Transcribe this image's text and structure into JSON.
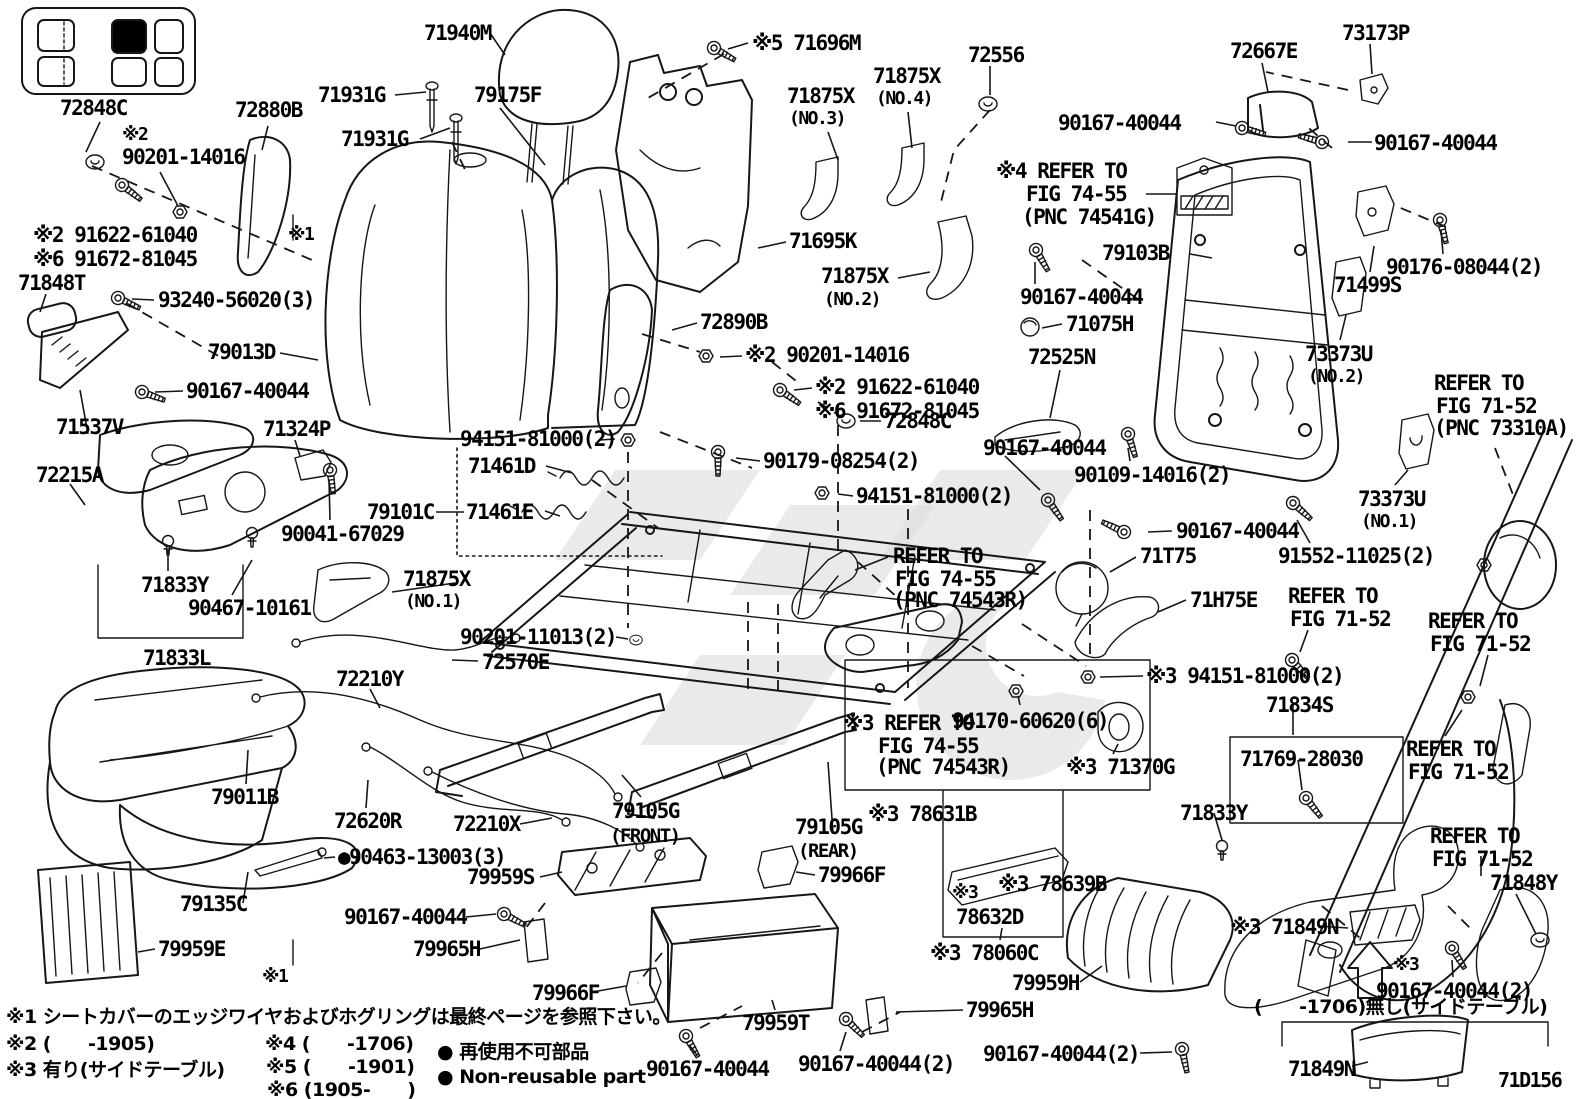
{
  "meta": {
    "figure_code": "71D156",
    "description_visible_language": "Japanese/English parts diagram"
  },
  "accent_colors": {
    "line": "#161616",
    "background": "#ffffff",
    "watermark": "#dcdcdc"
  },
  "labels": [
    {
      "text": "72848C",
      "x": 60,
      "y": 97
    },
    {
      "text": "※2",
      "x": 122,
      "y": 126,
      "fs": 18
    },
    {
      "text": "90201-14016",
      "x": 122,
      "y": 146
    },
    {
      "text": "72880B",
      "x": 235,
      "y": 99
    },
    {
      "text": "71931G",
      "x": 318,
      "y": 84
    },
    {
      "text": "71931G",
      "x": 341,
      "y": 128
    },
    {
      "text": "79175F",
      "x": 474,
      "y": 84
    },
    {
      "text": "71940M",
      "x": 424,
      "y": 22
    },
    {
      "text": "※5 71696M",
      "x": 752,
      "y": 32
    },
    {
      "text": "71875X",
      "x": 787,
      "y": 85
    },
    {
      "text": "(NO.3)",
      "x": 789,
      "y": 110,
      "fs": 18
    },
    {
      "text": "71875X",
      "x": 873,
      "y": 65
    },
    {
      "text": "(NO.4)",
      "x": 876,
      "y": 90,
      "fs": 18
    },
    {
      "text": "72556",
      "x": 968,
      "y": 44
    },
    {
      "text": "71695K",
      "x": 789,
      "y": 230
    },
    {
      "text": "71875X",
      "x": 821,
      "y": 265
    },
    {
      "text": "(NO.2)",
      "x": 824,
      "y": 291,
      "fs": 18
    },
    {
      "text": "90167-40044",
      "x": 1020,
      "y": 286
    },
    {
      "text": "71075H",
      "x": 1066,
      "y": 313
    },
    {
      "text": "72525N",
      "x": 1028,
      "y": 346
    },
    {
      "text": "90167-40044",
      "x": 1058,
      "y": 112
    },
    {
      "text": "72667E",
      "x": 1230,
      "y": 40
    },
    {
      "text": "73173P",
      "x": 1342,
      "y": 22
    },
    {
      "text": "90167-40044",
      "x": 1374,
      "y": 132
    },
    {
      "text": "※4 REFER TO",
      "x": 996,
      "y": 160
    },
    {
      "text": "FIG 74-55",
      "x": 1026,
      "y": 183
    },
    {
      "text": "(PNC 74541G)",
      "x": 1022,
      "y": 206
    },
    {
      "text": "79103B",
      "x": 1102,
      "y": 242
    },
    {
      "text": "90176-08044(2)",
      "x": 1386,
      "y": 256
    },
    {
      "text": "71499S",
      "x": 1334,
      "y": 274
    },
    {
      "text": "73373U",
      "x": 1305,
      "y": 343
    },
    {
      "text": "(NO.2)",
      "x": 1308,
      "y": 368,
      "fs": 18
    },
    {
      "text": "REFER TO",
      "x": 1434,
      "y": 372
    },
    {
      "text": "FIG 71-52",
      "x": 1436,
      "y": 395
    },
    {
      "text": "(PNC 73310A)",
      "x": 1434,
      "y": 417
    },
    {
      "text": "72890B",
      "x": 700,
      "y": 311
    },
    {
      "text": "※2 90201-14016",
      "x": 745,
      "y": 344
    },
    {
      "text": "※2 91622-61040",
      "x": 815,
      "y": 376
    },
    {
      "text": "※6 91672-81045",
      "x": 815,
      "y": 400
    },
    {
      "text": "72848C",
      "x": 884,
      "y": 410
    },
    {
      "text": "※2 91622-61040",
      "x": 33,
      "y": 224
    },
    {
      "text": "※6 91672-81045",
      "x": 33,
      "y": 248
    },
    {
      "text": "71848T",
      "x": 18,
      "y": 272
    },
    {
      "text": "93240-56020(3)",
      "x": 158,
      "y": 289
    },
    {
      "text": "79013D",
      "x": 208,
      "y": 341
    },
    {
      "text": "90167-40044",
      "x": 186,
      "y": 380
    },
    {
      "text": "71537V",
      "x": 56,
      "y": 416
    },
    {
      "text": "72215A",
      "x": 36,
      "y": 464
    },
    {
      "text": "71324P",
      "x": 263,
      "y": 418
    },
    {
      "text": "90041-67029",
      "x": 281,
      "y": 523
    },
    {
      "text": "71833Y",
      "x": 141,
      "y": 574
    },
    {
      "text": "90467-10161",
      "x": 188,
      "y": 597
    },
    {
      "text": "71833L",
      "x": 143,
      "y": 647
    },
    {
      "text": "※1",
      "x": 288,
      "y": 226,
      "fs": 18
    },
    {
      "text": "※1",
      "x": 262,
      "y": 968,
      "fs": 18
    },
    {
      "text": "94151-81000(2)",
      "x": 460,
      "y": 428
    },
    {
      "text": "71461D",
      "x": 468,
      "y": 455
    },
    {
      "text": "79101C",
      "x": 367,
      "y": 501
    },
    {
      "text": "71461E",
      "x": 466,
      "y": 501
    },
    {
      "text": "90179-08254(2)",
      "x": 763,
      "y": 450
    },
    {
      "text": "94151-81000(2)",
      "x": 856,
      "y": 485
    },
    {
      "text": "90167-40044",
      "x": 983,
      "y": 437
    },
    {
      "text": "90109-14016(2)",
      "x": 1074,
      "y": 464
    },
    {
      "text": "REFER TO",
      "x": 893,
      "y": 545
    },
    {
      "text": "FIG 74-55",
      "x": 895,
      "y": 568
    },
    {
      "text": "(PNC 74543R)",
      "x": 893,
      "y": 589
    },
    {
      "text": "90167-40044",
      "x": 1176,
      "y": 520
    },
    {
      "text": "71T75",
      "x": 1140,
      "y": 545
    },
    {
      "text": "73373U",
      "x": 1358,
      "y": 488
    },
    {
      "text": "(NO.1)",
      "x": 1361,
      "y": 513,
      "fs": 18
    },
    {
      "text": "91552-11025(2)",
      "x": 1278,
      "y": 545
    },
    {
      "text": "71H75E",
      "x": 1190,
      "y": 589
    },
    {
      "text": "REFER TO",
      "x": 1288,
      "y": 585
    },
    {
      "text": "FIG 71-52",
      "x": 1290,
      "y": 608
    },
    {
      "text": "REFER TO",
      "x": 1428,
      "y": 610
    },
    {
      "text": "FIG 71-52",
      "x": 1430,
      "y": 633
    },
    {
      "text": "71875X",
      "x": 403,
      "y": 568
    },
    {
      "text": "(NO.1)",
      "x": 405,
      "y": 593,
      "fs": 18
    },
    {
      "text": "90201-11013(2)",
      "x": 460,
      "y": 626
    },
    {
      "text": "72570E",
      "x": 482,
      "y": 651
    },
    {
      "text": "72210Y",
      "x": 336,
      "y": 668
    },
    {
      "text": "79011B",
      "x": 211,
      "y": 786
    },
    {
      "text": "72620R",
      "x": 334,
      "y": 810
    },
    {
      "text": "72210X",
      "x": 453,
      "y": 813
    },
    {
      "text": "●90463-13003(3)",
      "x": 338,
      "y": 846
    },
    {
      "text": "79959S",
      "x": 467,
      "y": 866
    },
    {
      "text": "90167-40044",
      "x": 344,
      "y": 906
    },
    {
      "text": "79965H",
      "x": 413,
      "y": 938
    },
    {
      "text": "79959E",
      "x": 158,
      "y": 938
    },
    {
      "text": "79135C",
      "x": 180,
      "y": 893
    },
    {
      "text": "79105G",
      "x": 612,
      "y": 800
    },
    {
      "text": "(FRONT)",
      "x": 610,
      "y": 827,
      "fs": 19
    },
    {
      "text": "79105G",
      "x": 795,
      "y": 816
    },
    {
      "text": "(REAR)",
      "x": 798,
      "y": 842,
      "fs": 19
    },
    {
      "text": "79966F",
      "x": 818,
      "y": 864
    },
    {
      "text": "79966F",
      "x": 532,
      "y": 982
    },
    {
      "text": "79959T",
      "x": 742,
      "y": 1012
    },
    {
      "text": "90167-40044",
      "x": 646,
      "y": 1058
    },
    {
      "text": "90167-40044(2)",
      "x": 798,
      "y": 1053
    },
    {
      "text": "90167-40044(2)",
      "x": 983,
      "y": 1043
    },
    {
      "text": "79965H",
      "x": 966,
      "y": 999
    },
    {
      "text": "79959H",
      "x": 1012,
      "y": 972
    },
    {
      "text": "※3 78060C",
      "x": 930,
      "y": 942
    },
    {
      "text": "※3",
      "x": 952,
      "y": 884,
      "fs": 18
    },
    {
      "text": "78632D",
      "x": 956,
      "y": 906
    },
    {
      "text": "※3 78639B",
      "x": 998,
      "y": 873
    },
    {
      "text": "※3 78631B",
      "x": 868,
      "y": 803
    },
    {
      "text": "94170-60620(6)",
      "x": 952,
      "y": 710
    },
    {
      "text": "※3 REFER TO",
      "x": 843,
      "y": 712
    },
    {
      "text": "FIG 74-55",
      "x": 878,
      "y": 735
    },
    {
      "text": "(PNC 74543R)",
      "x": 876,
      "y": 756
    },
    {
      "text": "※3 71370G",
      "x": 1066,
      "y": 756
    },
    {
      "text": "※3 94151-81000(2)",
      "x": 1146,
      "y": 665
    },
    {
      "text": "71834S",
      "x": 1266,
      "y": 694
    },
    {
      "text": "71769-28030",
      "x": 1240,
      "y": 748
    },
    {
      "text": "71833Y",
      "x": 1180,
      "y": 802
    },
    {
      "text": "REFER TO",
      "x": 1406,
      "y": 738
    },
    {
      "text": "FIG 71-52",
      "x": 1408,
      "y": 761
    },
    {
      "text": "REFER TO",
      "x": 1430,
      "y": 825
    },
    {
      "text": "FIG 71-52",
      "x": 1432,
      "y": 848
    },
    {
      "text": "71848Y",
      "x": 1490,
      "y": 872
    },
    {
      "text": "※3 71849N",
      "x": 1230,
      "y": 916
    },
    {
      "text": "※3",
      "x": 1393,
      "y": 956,
      "fs": 18
    },
    {
      "text": "90167-40044(2)",
      "x": 1376,
      "y": 980
    },
    {
      "text": "(　　-1706)無し(サイドテーブル)",
      "x": 1254,
      "y": 998,
      "fs": 19,
      "cls": "jp"
    },
    {
      "text": "71849N",
      "x": 1288,
      "y": 1058
    },
    {
      "text": "71D156",
      "x": 1498,
      "y": 1070,
      "fs": 20
    },
    {
      "text": "※1 シートカバーのエッジワイヤおよびホグリングは最終ページを参照下さい。",
      "x": 6,
      "y": 1008,
      "fs": 19,
      "cls": "jp"
    },
    {
      "text": "※2 (　　-1905)",
      "x": 6,
      "y": 1035,
      "fs": 19,
      "cls": "jp"
    },
    {
      "text": "※3 有り(サイドテーブル)",
      "x": 6,
      "y": 1061,
      "fs": 19,
      "cls": "jp"
    },
    {
      "text": "※4 (　　-1706)",
      "x": 265,
      "y": 1035,
      "fs": 19,
      "cls": "jp"
    },
    {
      "text": "※5 (　　-1901)",
      "x": 266,
      "y": 1058,
      "fs": 19,
      "cls": "jp"
    },
    {
      "text": "※6 (1905-　　)",
      "x": 267,
      "y": 1081,
      "fs": 19,
      "cls": "jp"
    },
    {
      "text": "● 再使用不可部品",
      "x": 437,
      "y": 1043,
      "fs": 19,
      "cls": "jp"
    },
    {
      "text": "● Non-reusable part",
      "x": 437,
      "y": 1068,
      "fs": 19,
      "cls": "jp"
    }
  ]
}
